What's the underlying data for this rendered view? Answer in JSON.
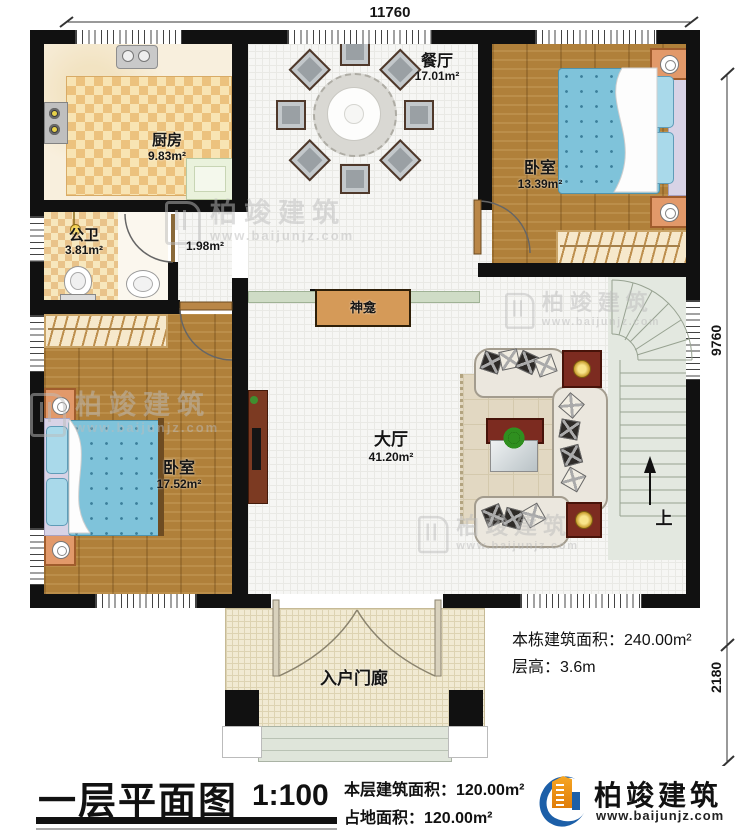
{
  "plan": {
    "dim_top": "11760",
    "dim_right_main": "9760",
    "dim_right_porch": "2180",
    "rooms": {
      "kitchen": {
        "name": "厨房",
        "area": "9.83m²"
      },
      "bathroom": {
        "name": "公卫",
        "area": "3.81m²"
      },
      "hallway": {
        "area": "1.98m²"
      },
      "dining": {
        "name": "餐厅",
        "area": "17.01m²"
      },
      "bedroom_top": {
        "name": "卧室",
        "area": "13.39m²"
      },
      "bedroom_left": {
        "name": "卧室",
        "area": "17.52m²"
      },
      "hall": {
        "name": "大厅",
        "area": "41.20m²"
      },
      "porch": {
        "name": "入户门廊"
      },
      "shrine": {
        "name": "神龛"
      },
      "stairs": {
        "up_label": "上"
      }
    },
    "notes": {
      "building_area": "本栋建筑面积：240.00m²",
      "floor_height": "层高：3.6m"
    }
  },
  "titlebar": {
    "title": "一层平面图",
    "scale": "1:100",
    "floor_area": "本层建筑面积：120.00m²",
    "land_area": "占地面积：120.00m²"
  },
  "brand": {
    "name": "柏竣建筑",
    "site": "www.baijunjz.com"
  },
  "watermark": {
    "name": "柏竣建筑",
    "site": "www.baijunjz.com"
  },
  "colors": {
    "brand_blue": "#1c5fa8",
    "brand_orange": "#f29200",
    "wall": "#111111",
    "bed_blue": "#7fc3da"
  }
}
